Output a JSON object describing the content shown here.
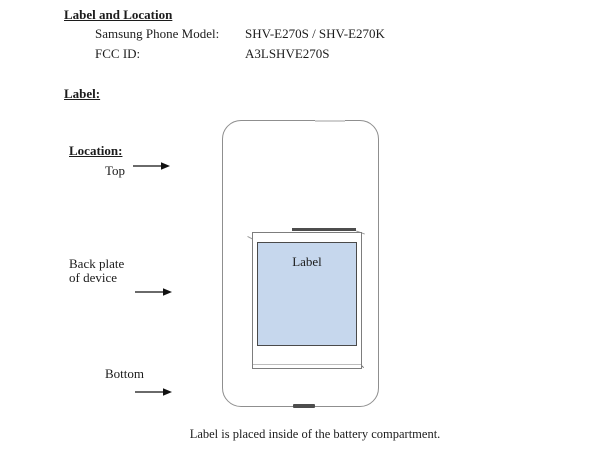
{
  "document": {
    "title": "Label and Location",
    "fields": [
      {
        "label": "Samsung Phone Model:",
        "value": "SHV-E270S / SHV-E270K"
      },
      {
        "label": "FCC ID:",
        "value": "A3LSHVE270S"
      }
    ],
    "label_heading": "Label:",
    "location_heading": "Location:",
    "markers": {
      "top": "Top",
      "back_line1": "Back plate",
      "back_line2": "of device",
      "bottom": "Bottom"
    },
    "diagram": {
      "label": "Label"
    },
    "caption": "Label is placed inside of the battery compartment.",
    "colors": {
      "label_fill": "#c6d7ed",
      "label_border": "#4a4a4a",
      "phone_outline": "#8f8f8f",
      "text": "#1c1c1c"
    }
  }
}
